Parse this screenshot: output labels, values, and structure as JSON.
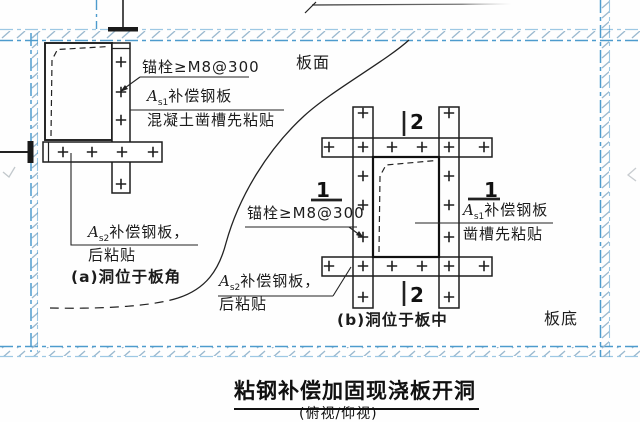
{
  "title": {
    "main": "粘钢补偿加固现浇板开洞",
    "sub": "(俯视/仰视)"
  },
  "labels": {
    "board_top": "板面",
    "board_bottom": "板底",
    "anchor": "锚栓≥M8@300",
    "as1": {
      "a": "A",
      "sub": "s1",
      "rest": "补偿钢板"
    },
    "as2": {
      "a": "A",
      "sub": "s2",
      "rest": "补偿钢板，"
    },
    "note_groove_a": "混凝土凿槽先粘贴",
    "note_groove_b": "凿槽先粘贴",
    "note_after": "后粘贴",
    "caption_a": "(a)洞位于板角",
    "caption_b": "(b)洞位于板中",
    "section_1": "1",
    "section_2": "2"
  },
  "colors": {
    "border": "#4d9bcd",
    "hatch": "#9bb9cf",
    "ink": "#222222"
  }
}
